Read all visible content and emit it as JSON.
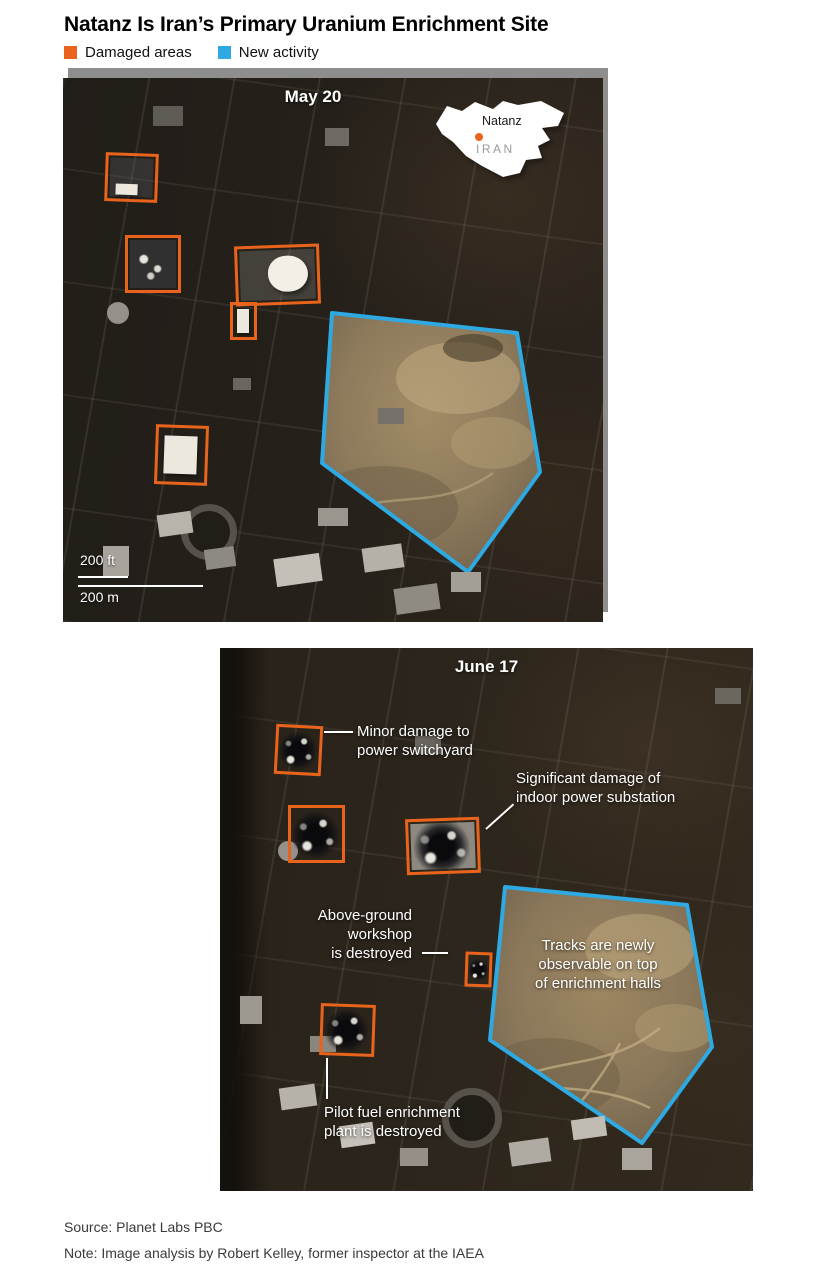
{
  "header": {
    "title": "Natanz Is Iran’s Primary Uranium Enrichment Site"
  },
  "legend": {
    "damaged_label": "Damaged areas",
    "new_label": "New activity",
    "damaged_color": "#E8641C",
    "new_color": "#2FA9E1"
  },
  "may": {
    "label": "May 20",
    "inset": {
      "city": "Natanz",
      "country": "IRAN"
    },
    "scale_ft": "200 ft",
    "scale_m": "200 m"
  },
  "june": {
    "label": "June 17",
    "annotations": {
      "switchyard": "Minor damage to\npower switchyard",
      "substation": "Significant damage of\nindoor power substation",
      "workshop": "Above-ground\nworkshop\nis destroyed",
      "tracks": "Tracks are newly\nobservable on top\nof enrichment halls",
      "pilot": "Pilot fuel enrichment\nplant is destroyed"
    }
  },
  "footer": {
    "source": "Source: Planet Labs PBC",
    "note": "Note: Image analysis by Robert Kelley, former inspector at the IAEA"
  }
}
